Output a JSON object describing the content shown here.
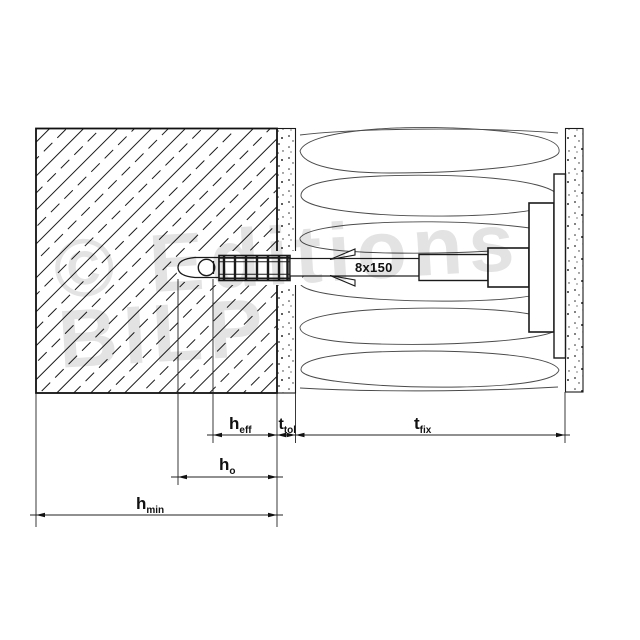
{
  "diagram": {
    "anchor_label": "8x150",
    "dimensions": {
      "h_eff": {
        "base": "h",
        "sub": "eff"
      },
      "t_tol": {
        "base": "t",
        "sub": "tol"
      },
      "t_fix": {
        "base": "t",
        "sub": "fix"
      },
      "h_o": {
        "base": "h",
        "sub": "o"
      },
      "h_min": {
        "base": "h",
        "sub": "min"
      }
    }
  },
  "watermark": {
    "line1": "© Editions",
    "line2": "BILP"
  },
  "colors": {
    "line": "#1a1a1a",
    "insulation_line": "#4a4a4a",
    "watermark": "#e3e3e3",
    "background": "#ffffff"
  }
}
